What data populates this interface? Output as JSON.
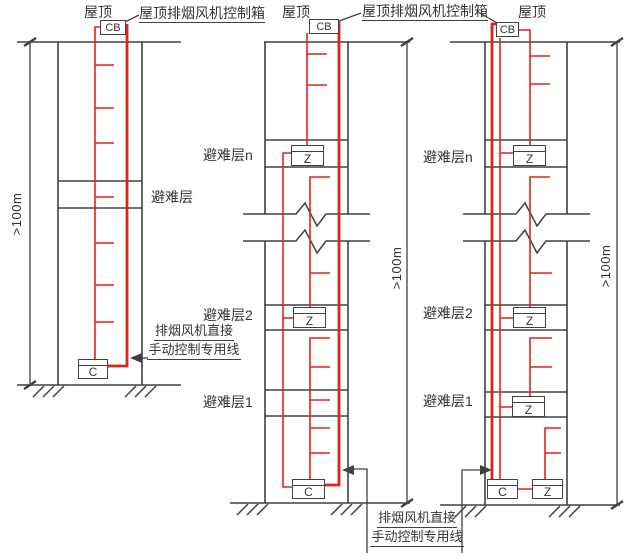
{
  "colors": {
    "structure_line": "#414141",
    "control_wire": "#e0241c",
    "background": "#ffffff"
  },
  "labels": {
    "roof": "屋顶",
    "roof_fan_control_box": "屋顶排烟风机控制箱",
    "refuge_floor": "避难层",
    "refuge_floor_n": "避难层n",
    "refuge_floor_2": "避难层2",
    "refuge_floor_1": "避难层1",
    "height_dimension": ">100m",
    "manual_line_text1": "排烟风机直接",
    "manual_line_text2": "手动控制专用线"
  },
  "devices": {
    "roof_control_box": "CB",
    "branch_box": "Z",
    "control_box": "C"
  }
}
